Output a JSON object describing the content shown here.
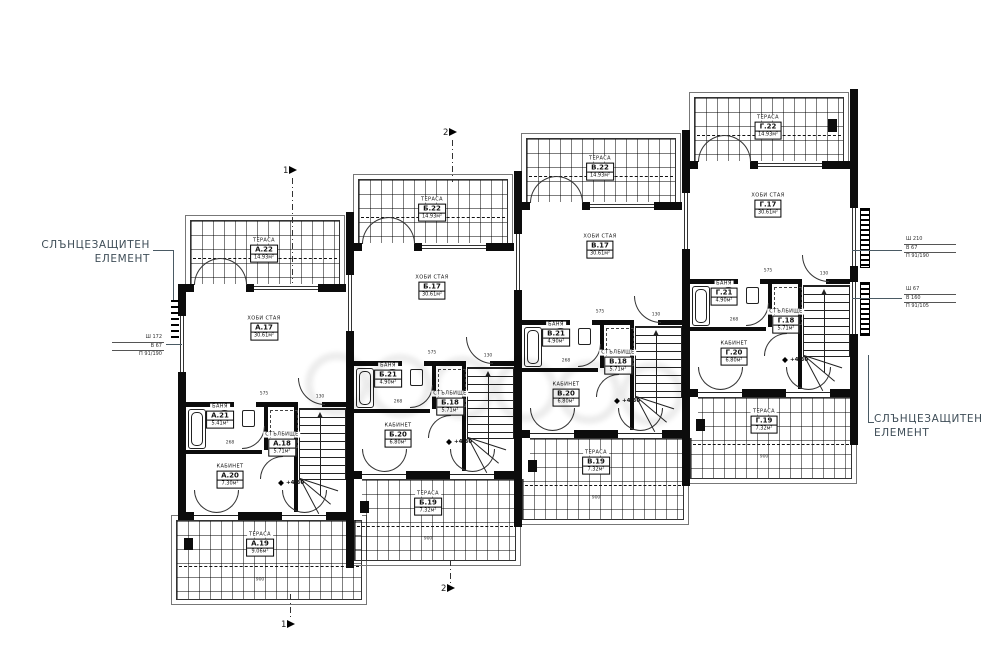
{
  "drawing": {
    "level_mark": "+4.30",
    "annotations": {
      "left_note": {
        "line1": "СЛЪНЦЕЗАЩИТЕН",
        "line2": "ЕЛЕМЕНТ"
      },
      "right_note": {
        "line1": "СЛЪНЦЕЗАЩИТЕН",
        "line2": "ЕЛЕМЕНТ"
      },
      "schedules": {
        "left": [
          "Ш 172",
          "В 67",
          "П 91/190"
        ],
        "right_top": [
          "Ш 210",
          "В 67",
          "П 91/190"
        ],
        "right_bottom": [
          "Ш 67",
          "В 160",
          "П 91/105"
        ]
      }
    },
    "sections": [
      {
        "label": "1"
      },
      {
        "label": "2"
      },
      {
        "label": "1"
      },
      {
        "label": "2"
      }
    ],
    "dims": {
      "hobby_w": "575",
      "cabinet_w": "268",
      "stair_w": "130",
      "terrace_w": "900"
    }
  },
  "units": [
    {
      "id": "А",
      "rooms": {
        "terrace_top": {
          "name": "ТЕРАСА",
          "number": "А.22",
          "area": "14.93м²"
        },
        "hobby": {
          "name": "ХОБИ СТАЯ",
          "number": "А.17",
          "area": "30.61м²"
        },
        "bath": {
          "name": "БАНЯ",
          "number": "А.21",
          "area": "5.41м²"
        },
        "stair": {
          "name": "СТЪЛБИЩЕ",
          "number": "А.18",
          "area": "5.71м²"
        },
        "cabinet": {
          "name": "КАБИНЕТ",
          "number": "А.20",
          "area": "7.30м²"
        },
        "terrace_bottom": {
          "name": "ТЕРАСА",
          "number": "А.19",
          "area": "9.06м²"
        }
      }
    },
    {
      "id": "Б",
      "rooms": {
        "terrace_top": {
          "name": "ТЕРАСА",
          "number": "Б.22",
          "area": "14.93м²"
        },
        "hobby": {
          "name": "ХОБИ СТАЯ",
          "number": "Б.17",
          "area": "30.61м²"
        },
        "bath": {
          "name": "БАНЯ",
          "number": "Б.21",
          "area": "4.90м²"
        },
        "stair": {
          "name": "СТЪЛБИЩЕ",
          "number": "Б.18",
          "area": "5.71м²"
        },
        "cabinet": {
          "name": "КАБИНЕТ",
          "number": "Б.20",
          "area": "6.80м²"
        },
        "terrace_bottom": {
          "name": "ТЕРАСА",
          "number": "Б.19",
          "area": "7.32м²"
        }
      }
    },
    {
      "id": "В",
      "rooms": {
        "terrace_top": {
          "name": "ТЕРАСА",
          "number": "В.22",
          "area": "14.93м²"
        },
        "hobby": {
          "name": "ХОБИ СТАЯ",
          "number": "В.17",
          "area": "30.61м²"
        },
        "bath": {
          "name": "БАНЯ",
          "number": "В.21",
          "area": "4.90м²"
        },
        "stair": {
          "name": "СТЪЛБИЩЕ",
          "number": "В.18",
          "area": "5.71м²"
        },
        "cabinet": {
          "name": "КАБИНЕТ",
          "number": "В.20",
          "area": "6.80м²"
        },
        "terrace_bottom": {
          "name": "ТЕРАСА",
          "number": "В.19",
          "area": "7.32м²"
        }
      }
    },
    {
      "id": "Г",
      "rooms": {
        "terrace_top": {
          "name": "ТЕРАСА",
          "number": "Г.22",
          "area": "14.93м²"
        },
        "hobby": {
          "name": "ХОБИ СТАЯ",
          "number": "Г.17",
          "area": "30.61м²"
        },
        "bath": {
          "name": "БАНЯ",
          "number": "Г.21",
          "area": "4.90м²"
        },
        "stair": {
          "name": "СТЪЛБИЩЕ",
          "number": "Г.18",
          "area": "5.71м²"
        },
        "cabinet": {
          "name": "КАБИНЕТ",
          "number": "Г.20",
          "area": "6.80м²"
        },
        "terrace_bottom": {
          "name": "ТЕРАСА",
          "number": "Г.19",
          "area": "7.32м²"
        }
      }
    }
  ]
}
